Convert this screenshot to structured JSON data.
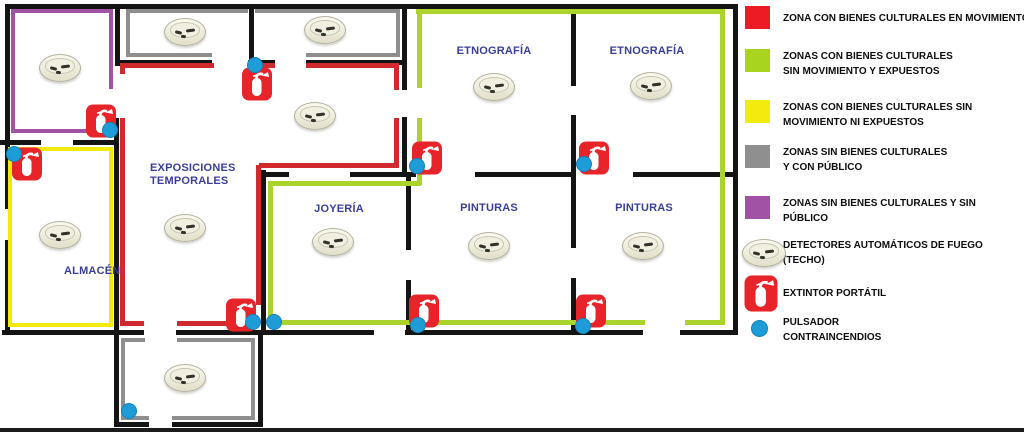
{
  "colors": {
    "wall": "#141414",
    "red_zone": "#d02a2e",
    "red_icon": "#e8242b",
    "green_zone": "#abd32b",
    "yellow_zone": "#f2ea0f",
    "gray_zone": "#8e8e8e",
    "purple_zone": "#a152a5",
    "dot_blue": "#1e9cd8",
    "label_blue": "#3b3e99"
  },
  "plan": {
    "walls": [
      [
        5,
        4,
        733,
        5
      ],
      [
        5,
        4,
        5,
        205
      ],
      [
        5,
        240,
        5,
        95
      ],
      [
        733,
        4,
        5,
        331
      ],
      [
        2,
        330,
        117,
        5
      ],
      [
        263,
        330,
        111,
        5
      ],
      [
        405,
        330,
        238,
        5
      ],
      [
        680,
        330,
        58,
        5
      ],
      [
        115,
        4,
        5,
        62
      ],
      [
        0,
        140,
        41,
        5
      ],
      [
        73,
        140,
        45,
        5
      ],
      [
        114,
        118,
        5,
        217
      ],
      [
        249,
        4,
        5,
        58
      ],
      [
        119,
        60,
        93,
        5
      ],
      [
        248,
        60,
        27,
        5
      ],
      [
        306,
        60,
        97,
        5
      ],
      [
        402,
        4,
        5,
        86
      ],
      [
        402,
        117,
        5,
        60
      ],
      [
        571,
        4,
        5,
        82
      ],
      [
        571,
        115,
        5,
        62
      ],
      [
        263,
        172,
        26,
        5
      ],
      [
        350,
        172,
        66,
        5
      ],
      [
        475,
        172,
        100,
        5
      ],
      [
        633,
        172,
        103,
        5
      ],
      [
        406,
        177,
        5,
        73
      ],
      [
        406,
        280,
        5,
        53
      ],
      [
        571,
        177,
        5,
        71
      ],
      [
        571,
        278,
        5,
        55
      ],
      [
        261,
        170,
        5,
        163
      ],
      [
        114,
        335,
        5,
        92
      ],
      [
        258,
        335,
        5,
        92
      ],
      [
        119,
        330,
        25,
        5
      ],
      [
        176,
        330,
        87,
        5
      ],
      [
        114,
        422,
        35,
        5
      ],
      [
        172,
        422,
        91,
        5
      ]
    ],
    "zone_lines": [
      {
        "c": "purple_zone",
        "r": [
          11,
          9,
          4,
          124
        ]
      },
      {
        "c": "purple_zone",
        "r": [
          11,
          9,
          102,
          4
        ]
      },
      {
        "c": "purple_zone",
        "r": [
          109,
          9,
          4,
          80
        ]
      },
      {
        "c": "purple_zone",
        "r": [
          11,
          129,
          79,
          4
        ]
      },
      {
        "c": "gray_zone",
        "r": [
          126,
          9,
          4,
          48
        ]
      },
      {
        "c": "gray_zone",
        "r": [
          126,
          9,
          122,
          4
        ]
      },
      {
        "c": "gray_zone",
        "r": [
          126,
          53,
          86,
          4
        ]
      },
      {
        "c": "gray_zone",
        "r": [
          255,
          9,
          145,
          4
        ]
      },
      {
        "c": "gray_zone",
        "r": [
          396,
          9,
          4,
          48
        ]
      },
      {
        "c": "gray_zone",
        "r": [
          306,
          53,
          94,
          4
        ]
      },
      {
        "c": "gray_zone",
        "r": [
          121,
          338,
          4,
          82
        ]
      },
      {
        "c": "gray_zone",
        "r": [
          121,
          338,
          24,
          4
        ]
      },
      {
        "c": "gray_zone",
        "r": [
          177,
          338,
          78,
          4
        ]
      },
      {
        "c": "gray_zone",
        "r": [
          251,
          338,
          4,
          82
        ]
      },
      {
        "c": "gray_zone",
        "r": [
          125,
          416,
          24,
          4
        ]
      },
      {
        "c": "gray_zone",
        "r": [
          172,
          416,
          83,
          4
        ]
      },
      {
        "c": "yellow_zone",
        "r": [
          8,
          147,
          4,
          180
        ]
      },
      {
        "c": "yellow_zone",
        "r": [
          8,
          147,
          105,
          4
        ]
      },
      {
        "c": "yellow_zone",
        "r": [
          109,
          147,
          4,
          180
        ]
      },
      {
        "c": "yellow_zone",
        "r": [
          8,
          323,
          105,
          4
        ]
      },
      {
        "c": "red_zone",
        "r": [
          122,
          63,
          92,
          5
        ]
      },
      {
        "c": "red_zone",
        "r": [
          261,
          63,
          14,
          5
        ]
      },
      {
        "c": "red_zone",
        "r": [
          306,
          63,
          88,
          5
        ]
      },
      {
        "c": "red_zone",
        "r": [
          394,
          63,
          5,
          27
        ]
      },
      {
        "c": "red_zone",
        "r": [
          394,
          118,
          5,
          50
        ]
      },
      {
        "c": "red_zone",
        "r": [
          259,
          163,
          140,
          5
        ]
      },
      {
        "c": "red_zone",
        "r": [
          256,
          165,
          5,
          140
        ]
      },
      {
        "c": "red_zone",
        "r": [
          120,
          63,
          5,
          11
        ]
      },
      {
        "c": "red_zone",
        "r": [
          120,
          118,
          5,
          208
        ]
      },
      {
        "c": "red_zone",
        "r": [
          120,
          321,
          24,
          5
        ]
      },
      {
        "c": "red_zone",
        "r": [
          177,
          321,
          60,
          5
        ]
      },
      {
        "c": "red_zone",
        "r": [
          232,
          300,
          5,
          24
        ]
      },
      {
        "c": "green_zone",
        "r": [
          416,
          9,
          309,
          5
        ]
      },
      {
        "c": "green_zone",
        "r": [
          720,
          9,
          5,
          316
        ]
      },
      {
        "c": "green_zone",
        "r": [
          417,
          9,
          5,
          79
        ]
      },
      {
        "c": "green_zone",
        "r": [
          417,
          118,
          5,
          67
        ]
      },
      {
        "c": "green_zone",
        "r": [
          270,
          181,
          151,
          5
        ]
      },
      {
        "c": "green_zone",
        "r": [
          268,
          181,
          5,
          144
        ]
      },
      {
        "c": "green_zone",
        "r": [
          268,
          320,
          312,
          5
        ]
      },
      {
        "c": "green_zone",
        "r": [
          605,
          320,
          40,
          5
        ]
      },
      {
        "c": "green_zone",
        "r": [
          685,
          320,
          40,
          5
        ]
      }
    ],
    "detectors": [
      [
        60,
        68
      ],
      [
        185,
        32
      ],
      [
        325,
        30
      ],
      [
        494,
        87
      ],
      [
        651,
        86
      ],
      [
        315,
        116
      ],
      [
        185,
        228
      ],
      [
        60,
        235
      ],
      [
        333,
        242
      ],
      [
        489,
        246
      ],
      [
        643,
        246
      ],
      [
        185,
        378
      ]
    ],
    "extinguishers": [
      [
        101,
        121
      ],
      [
        27,
        164
      ],
      [
        257,
        84
      ],
      [
        427,
        158
      ],
      [
        594,
        158
      ],
      [
        241,
        315
      ],
      [
        424,
        311
      ],
      [
        591,
        311
      ]
    ],
    "pulsadores": [
      [
        110,
        130
      ],
      [
        14,
        154
      ],
      [
        255,
        65
      ],
      [
        417,
        166
      ],
      [
        584,
        164
      ],
      [
        253,
        322
      ],
      [
        274,
        322
      ],
      [
        418,
        325
      ],
      [
        583,
        326
      ],
      [
        129,
        411
      ]
    ],
    "labels": [
      {
        "lines": [
          "ETNOGRAFÍA"
        ],
        "x": 494,
        "y": 45,
        "align": "center"
      },
      {
        "lines": [
          "ETNOGRAFÍA"
        ],
        "x": 647,
        "y": 45,
        "align": "center"
      },
      {
        "lines": [
          "EXPOSICIONES",
          "TEMPORALES"
        ],
        "x": 150,
        "y": 162,
        "align": "left"
      },
      {
        "lines": [
          "JOYERÍA"
        ],
        "x": 339,
        "y": 203,
        "align": "center"
      },
      {
        "lines": [
          "PINTURAS"
        ],
        "x": 489,
        "y": 202,
        "align": "center"
      },
      {
        "lines": [
          "PINTURAS"
        ],
        "x": 644,
        "y": 202,
        "align": "center"
      },
      {
        "lines": [
          "ALMACÉN"
        ],
        "x": 64,
        "y": 265,
        "align": "left"
      }
    ]
  },
  "legend": {
    "items": [
      {
        "type": "square",
        "color": "#ec1c24",
        "top": 6,
        "text_pad": 5,
        "lines": [
          "ZONA CON BIENES CULTURALES EN MOVIMIENTO"
        ]
      },
      {
        "type": "square",
        "color": "#a8d41f",
        "top": 49,
        "text_pad": 0,
        "lines": [
          "ZONAS CON BIENES CULTURALES",
          "SIN MOVIMIENTO Y EXPUESTOS"
        ]
      },
      {
        "type": "square",
        "color": "#f4eb0e",
        "top": 100,
        "text_pad": 0,
        "lines": [
          "ZONAS CON BIENES CULTURALES SIN",
          "MOVIMIENTO NI EXPUESTOS"
        ]
      },
      {
        "type": "square",
        "color": "#8f8f8f",
        "top": 145,
        "text_pad": 0,
        "lines": [
          "ZONAS SIN BIENES CULTURALES",
          "Y CON PÚBLICO"
        ]
      },
      {
        "type": "square",
        "color": "#a152a5",
        "top": 196,
        "text_pad": 0,
        "lines": [
          "ZONAS SIN BIENES CULTURALES Y SIN",
          "PÚBLICO"
        ]
      },
      {
        "type": "detector",
        "top": 238,
        "text_pad": 0,
        "lines": [
          "DETECTORES AUTOMÁTICOS DE FUEGO",
          "(TECHO)"
        ]
      },
      {
        "type": "extinguisher",
        "top": 275,
        "text_pad": 11,
        "lines": [
          "EXTINTOR PORTÁTIL"
        ]
      },
      {
        "type": "dot",
        "top": 312,
        "text_pad": 3,
        "lines": [
          "PULSADOR",
          "CONTRAINCENDIOS"
        ]
      }
    ]
  }
}
